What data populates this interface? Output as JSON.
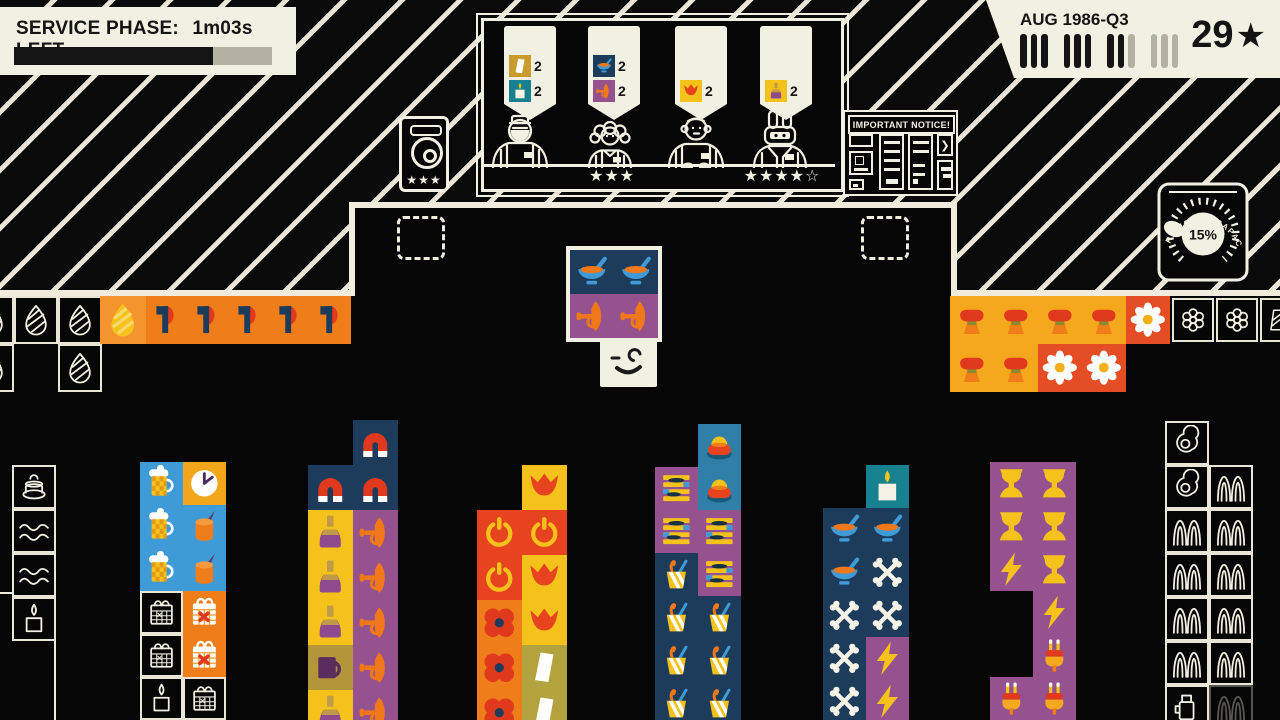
{
  "hud": {
    "service": {
      "label": "SERVICE PHASE:",
      "time": "1m03s LEFT",
      "progress_pct": 77
    },
    "date": {
      "label": "AUG 1986-Q3",
      "stars": "29",
      "star_icon": "★",
      "quarter_ticks": [
        [
          1,
          1,
          1
        ],
        [
          1,
          1,
          1
        ],
        [
          1,
          1,
          0
        ],
        [
          0,
          0,
          0
        ]
      ]
    }
  },
  "counter": {
    "bubbles": [
      {
        "items": [
          {
            "type": "wedge-gold",
            "count": 2
          },
          {
            "type": "candle-teal",
            "count": 2
          }
        ]
      },
      {
        "items": [
          {
            "type": "soup",
            "count": 2
          },
          {
            "type": "trumpet",
            "count": 2
          }
        ]
      },
      {
        "items": [
          {
            "type": "tulip",
            "count": 2
          }
        ]
      },
      {
        "items": [
          {
            "type": "bottle",
            "count": 2
          }
        ]
      }
    ],
    "customers": [
      {
        "variant": "bearded-man",
        "stars": ""
      },
      {
        "variant": "curly-haired-woman",
        "stars": "★★★"
      },
      {
        "variant": "bald-man",
        "stars": ""
      },
      {
        "variant": "rabbit",
        "stars": "★★★★☆"
      }
    ],
    "speaker": {
      "stars": "★★★"
    }
  },
  "notice_board": {
    "title": "IMPORTANT NOTICE!"
  },
  "gauge": {
    "value": "15%",
    "label": "OPERATIONAL CAPACITY"
  },
  "player": {
    "carried_tiles": [
      [
        570,
        250,
        44,
        44,
        "soup"
      ],
      [
        614,
        250,
        44,
        44,
        "soup"
      ],
      [
        570,
        294,
        44,
        44,
        "trumpet"
      ],
      [
        614,
        294,
        44,
        44,
        "trumpet"
      ]
    ]
  },
  "tile_types": {
    "egg-ghost": {
      "ghost": true,
      "icon": "egg-ghost"
    },
    "egg-solid": {
      "bg": "#f5942e",
      "icon": "egg-solid"
    },
    "axe": {
      "bg": "#ef7d1a",
      "icon": "axe"
    },
    "ham": {
      "bg": "#f6a81c",
      "icon": "ham"
    },
    "daisy": {
      "bg": "#e54e24",
      "icon": "daisy"
    },
    "flower-ghost": {
      "ghost": true,
      "icon": "flower-ghost"
    },
    "wedgestripe-ghost": {
      "ghost": true,
      "icon": "wedgestripe-ghost"
    },
    "cake-ghost": {
      "ghost": true,
      "icon": "cake-ghost"
    },
    "waves-ghost": {
      "ghost": true,
      "icon": "waves-ghost"
    },
    "candle-ghost": {
      "ghost": true,
      "icon": "candle-ghost"
    },
    "friedegg-ghost": {
      "ghost": true,
      "icon": "friedegg-ghost"
    },
    "grass-ghost": {
      "ghost": true,
      "icon": "grass-ghost"
    },
    "grass-ghost-faint": {
      "ghost": true,
      "faint": true,
      "icon": "grass-ghost"
    },
    "flask-ghost": {
      "ghost": true,
      "icon": "flask-ghost"
    },
    "calendar-ghost": {
      "ghost": true,
      "icon": "calendar-ghost"
    },
    "beer": {
      "bg": "#3f9bd8",
      "icon": "beer"
    },
    "clock": {
      "bg": "#f2a71b",
      "icon": "clock"
    },
    "candle-blue": {
      "bg": "#3f9bd8",
      "icon": "candle-orange"
    },
    "calendar": {
      "bg": "#ef7d1a",
      "icon": "calendar"
    },
    "magnet": {
      "bg": "#1d3c5c",
      "icon": "magnet"
    },
    "bottle": {
      "bg": "#f5c21b",
      "icon": "bottle"
    },
    "trumpet": {
      "bg": "#96518f",
      "icon": "trumpet"
    },
    "mug": {
      "bg": "#b3953a",
      "icon": "mug"
    },
    "tulip": {
      "bg": "#f5c21b",
      "icon": "tulip"
    },
    "power": {
      "bg": "#e8431f",
      "icon": "power"
    },
    "poppy": {
      "bg": "#ef7d1a",
      "icon": "poppy"
    },
    "wedge": {
      "bg": "#b3a33f",
      "icon": "wedge"
    },
    "wedge-gold": {
      "bg": "#c99b2e",
      "icon": "wedge"
    },
    "cake": {
      "bg": "#2f7fa8",
      "icon": "cake"
    },
    "stripes": {
      "bg": "#96518f",
      "icon": "stripes"
    },
    "milkshake": {
      "bg": "#1d3c5c",
      "icon": "milkshake"
    },
    "candle-teal": {
      "bg": "#17818f",
      "icon": "candle-teal"
    },
    "soup": {
      "bg": "#1d3c5c",
      "icon": "soup"
    },
    "bones": {
      "bg": "#1d3c5c",
      "icon": "bones"
    },
    "lightning": {
      "bg": "#96518f",
      "icon": "lightning"
    },
    "goblet": {
      "bg": "#96518f",
      "icon": "goblet"
    },
    "plug": {
      "bg": "#96518f",
      "icon": "plug"
    }
  },
  "board": {
    "tiles": [
      [
        -30,
        296,
        44,
        48,
        "egg-ghost"
      ],
      [
        14,
        296,
        44,
        48,
        "egg-ghost"
      ],
      [
        58,
        296,
        44,
        48,
        "egg-ghost"
      ],
      [
        -30,
        344,
        44,
        48,
        "egg-ghost"
      ],
      [
        58,
        344,
        44,
        48,
        "egg-ghost"
      ],
      [
        100,
        296,
        46,
        48,
        "egg-solid"
      ],
      [
        146,
        296,
        41,
        48,
        "axe"
      ],
      [
        187,
        296,
        41,
        48,
        "axe"
      ],
      [
        228,
        296,
        41,
        48,
        "axe"
      ],
      [
        269,
        296,
        41,
        48,
        "axe"
      ],
      [
        310,
        296,
        41,
        48,
        "axe"
      ],
      [
        950,
        296,
        44,
        48,
        "ham"
      ],
      [
        994,
        296,
        44,
        48,
        "ham"
      ],
      [
        1038,
        296,
        44,
        48,
        "ham"
      ],
      [
        1082,
        296,
        44,
        48,
        "ham"
      ],
      [
        1126,
        296,
        44,
        48,
        "daisy"
      ],
      [
        1172,
        298,
        42,
        44,
        "flower-ghost"
      ],
      [
        1216,
        298,
        42,
        44,
        "flower-ghost"
      ],
      [
        1260,
        298,
        38,
        44,
        "wedgestripe-ghost"
      ],
      [
        950,
        344,
        44,
        48,
        "ham"
      ],
      [
        994,
        344,
        44,
        48,
        "ham"
      ],
      [
        1038,
        344,
        44,
        48,
        "daisy"
      ],
      [
        1082,
        344,
        44,
        48,
        "daisy"
      ],
      [
        12,
        465,
        44,
        44,
        "cake-ghost"
      ],
      [
        12,
        509,
        44,
        44,
        "waves-ghost"
      ],
      [
        12,
        553,
        44,
        44,
        "waves-ghost"
      ],
      [
        12,
        597,
        44,
        44,
        "candle-ghost"
      ],
      [
        1165,
        421,
        44,
        44,
        "friedegg-ghost"
      ],
      [
        1165,
        465,
        44,
        44,
        "friedegg-ghost"
      ],
      [
        1165,
        509,
        44,
        44,
        "grass-ghost"
      ],
      [
        1165,
        553,
        44,
        44,
        "grass-ghost"
      ],
      [
        1165,
        597,
        44,
        44,
        "grass-ghost"
      ],
      [
        1165,
        641,
        44,
        44,
        "grass-ghost"
      ],
      [
        1165,
        685,
        44,
        44,
        "flask-ghost"
      ],
      [
        1209,
        465,
        44,
        44,
        "grass-ghost"
      ],
      [
        1209,
        509,
        44,
        44,
        "grass-ghost"
      ],
      [
        1209,
        553,
        44,
        44,
        "grass-ghost"
      ],
      [
        1209,
        597,
        44,
        44,
        "grass-ghost"
      ],
      [
        1209,
        641,
        44,
        44,
        "grass-ghost"
      ],
      [
        1209,
        685,
        44,
        44,
        "grass-ghost-faint"
      ],
      [
        140,
        462,
        43,
        43,
        "beer"
      ],
      [
        183,
        462,
        43,
        43,
        "clock"
      ],
      [
        140,
        505,
        43,
        43,
        "beer"
      ],
      [
        183,
        505,
        43,
        43,
        "candle-blue"
      ],
      [
        140,
        548,
        43,
        43,
        "beer"
      ],
      [
        183,
        548,
        43,
        43,
        "candle-blue"
      ],
      [
        140,
        591,
        43,
        43,
        "calendar-ghost"
      ],
      [
        183,
        591,
        43,
        43,
        "calendar"
      ],
      [
        140,
        634,
        43,
        43,
        "calendar-ghost"
      ],
      [
        183,
        634,
        43,
        43,
        "calendar"
      ],
      [
        140,
        677,
        43,
        43,
        "candle-ghost"
      ],
      [
        183,
        677,
        43,
        43,
        "calendar-ghost"
      ],
      [
        353,
        420,
        45,
        45,
        "magnet"
      ],
      [
        308,
        465,
        45,
        45,
        "magnet"
      ],
      [
        353,
        465,
        45,
        45,
        "magnet"
      ],
      [
        308,
        510,
        45,
        45,
        "bottle"
      ],
      [
        353,
        510,
        45,
        45,
        "trumpet"
      ],
      [
        308,
        555,
        45,
        45,
        "bottle"
      ],
      [
        353,
        555,
        45,
        45,
        "trumpet"
      ],
      [
        308,
        600,
        45,
        45,
        "bottle"
      ],
      [
        353,
        600,
        45,
        45,
        "trumpet"
      ],
      [
        308,
        645,
        45,
        45,
        "mug"
      ],
      [
        353,
        645,
        45,
        45,
        "trumpet"
      ],
      [
        308,
        690,
        45,
        45,
        "bottle"
      ],
      [
        353,
        690,
        45,
        45,
        "trumpet"
      ],
      [
        522,
        465,
        45,
        45,
        "tulip"
      ],
      [
        477,
        510,
        45,
        45,
        "power"
      ],
      [
        522,
        510,
        45,
        45,
        "power"
      ],
      [
        477,
        555,
        45,
        45,
        "power"
      ],
      [
        522,
        555,
        45,
        45,
        "tulip"
      ],
      [
        477,
        600,
        45,
        45,
        "poppy"
      ],
      [
        522,
        600,
        45,
        45,
        "tulip"
      ],
      [
        477,
        645,
        45,
        45,
        "poppy"
      ],
      [
        522,
        645,
        45,
        45,
        "wedge"
      ],
      [
        477,
        690,
        45,
        45,
        "poppy"
      ],
      [
        522,
        690,
        45,
        45,
        "wedge"
      ],
      [
        698,
        424,
        43,
        43,
        "cake"
      ],
      [
        655,
        467,
        43,
        43,
        "stripes"
      ],
      [
        698,
        467,
        43,
        43,
        "cake"
      ],
      [
        655,
        510,
        43,
        43,
        "stripes"
      ],
      [
        698,
        510,
        43,
        43,
        "stripes"
      ],
      [
        655,
        553,
        43,
        43,
        "milkshake"
      ],
      [
        698,
        553,
        43,
        43,
        "stripes"
      ],
      [
        655,
        596,
        43,
        43,
        "milkshake"
      ],
      [
        698,
        596,
        43,
        43,
        "milkshake"
      ],
      [
        655,
        639,
        43,
        43,
        "milkshake"
      ],
      [
        698,
        639,
        43,
        43,
        "milkshake"
      ],
      [
        655,
        682,
        43,
        43,
        "milkshake"
      ],
      [
        698,
        682,
        43,
        43,
        "milkshake"
      ],
      [
        866,
        465,
        43,
        43,
        "candle-teal"
      ],
      [
        823,
        508,
        43,
        43,
        "soup"
      ],
      [
        866,
        508,
        43,
        43,
        "soup"
      ],
      [
        823,
        551,
        43,
        43,
        "soup"
      ],
      [
        866,
        551,
        43,
        43,
        "bones"
      ],
      [
        823,
        594,
        43,
        43,
        "bones"
      ],
      [
        866,
        594,
        43,
        43,
        "bones"
      ],
      [
        823,
        637,
        43,
        43,
        "bones"
      ],
      [
        866,
        637,
        43,
        43,
        "lightning"
      ],
      [
        823,
        680,
        43,
        43,
        "bones"
      ],
      [
        866,
        680,
        43,
        43,
        "lightning"
      ],
      [
        990,
        462,
        43,
        43,
        "goblet"
      ],
      [
        1033,
        462,
        43,
        43,
        "goblet"
      ],
      [
        990,
        505,
        43,
        43,
        "goblet"
      ],
      [
        1033,
        505,
        43,
        43,
        "goblet"
      ],
      [
        990,
        548,
        43,
        43,
        "lightning"
      ],
      [
        1033,
        548,
        43,
        43,
        "goblet"
      ],
      [
        1033,
        591,
        43,
        43,
        "lightning"
      ],
      [
        1033,
        634,
        43,
        43,
        "plug"
      ],
      [
        990,
        677,
        43,
        43,
        "plug"
      ],
      [
        1033,
        677,
        43,
        43,
        "plug"
      ]
    ]
  }
}
